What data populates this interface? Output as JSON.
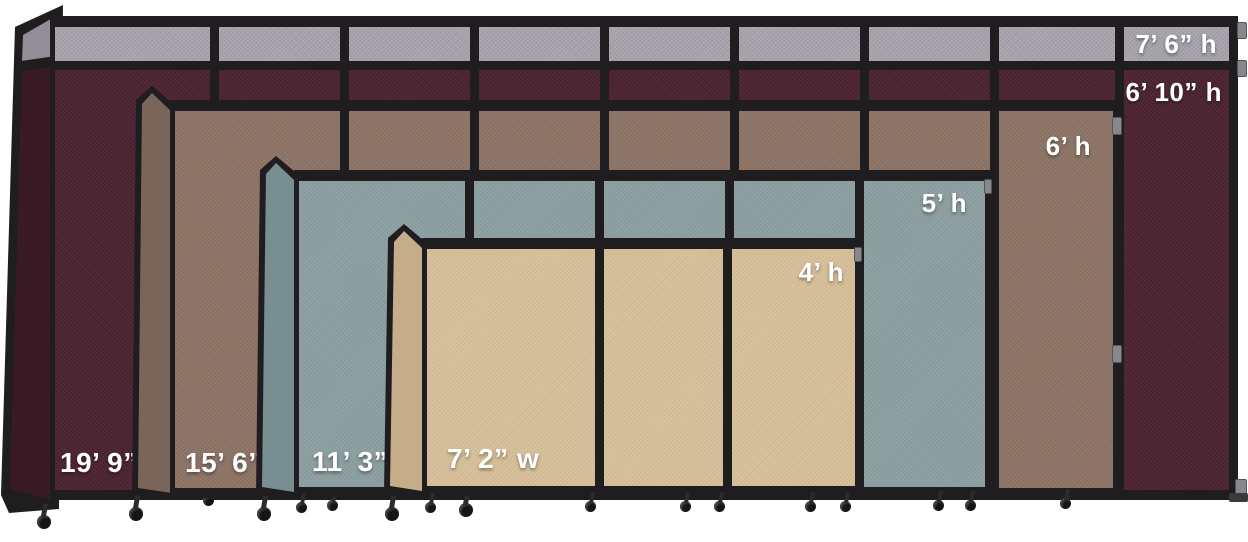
{
  "scene": {
    "background": "#ffffff",
    "frame_color": "#201d20",
    "label_color": "#ffffff",
    "top_strip_color": "#a7a3ac"
  },
  "partitions": [
    {
      "name": "burgundy-partition",
      "extended_height_label": "7’ 6” h",
      "height_label": "6’ 10” h",
      "width_label": "19’ 9” w",
      "face_color": "#4b2330",
      "side_color": "#3a1b25",
      "has_gray_top_strip": true,
      "panel_count": 9
    },
    {
      "name": "brown-partition",
      "height_label": "6’ h",
      "width_label": "15’ 6” w",
      "face_color": "#8d7466",
      "side_color": "#79655a",
      "panel_count": 7
    },
    {
      "name": "slate-partition",
      "height_label": "5’ h",
      "width_label": "11’ 3” w",
      "face_color": "#8da0a1",
      "side_color": "#798e91",
      "panel_count": 5
    },
    {
      "name": "sand-partition",
      "height_label": "4’ h",
      "width_label": "7’ 2” w",
      "face_color": "#d8c09a",
      "side_color": "#c4ad88",
      "panel_count": 3
    }
  ]
}
